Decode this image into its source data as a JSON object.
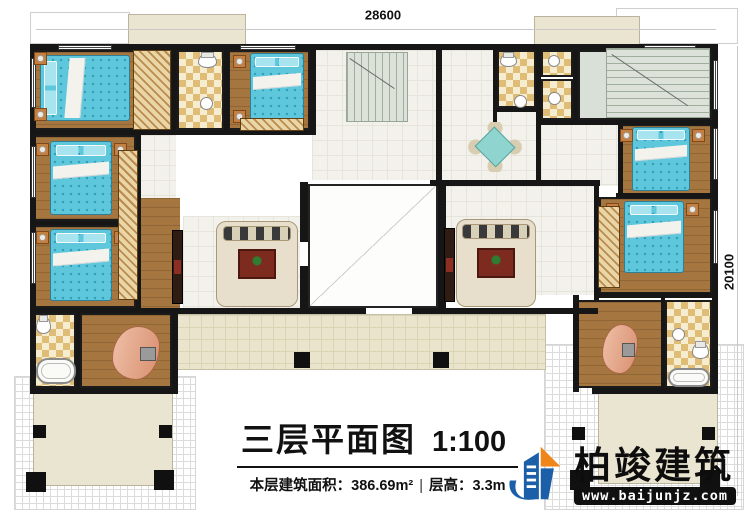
{
  "title_block": {
    "title": "三层平面图",
    "scale": "1:100",
    "area_label": "本层建筑面积：",
    "area_value": "386.69m²",
    "height_label": "层高：",
    "height_value": "3.3m"
  },
  "dimensions": {
    "top": "28600",
    "right": "20100"
  },
  "logo": {
    "name": "柏竣建筑",
    "url": "www.baijunjz.com"
  },
  "watermark": {
    "text": "柏竣建筑",
    "url": "www.baijunjz.com"
  },
  "watermarks": [
    {
      "x": 230,
      "y": 95
    },
    {
      "x": 590,
      "y": 193
    },
    {
      "x": 140,
      "y": 295
    },
    {
      "x": 478,
      "y": 408
    }
  ],
  "plan": {
    "rooms": [
      {
        "id": "lattice-bottom-left",
        "t": "lattice",
        "r": [
          14,
          376,
          182,
          134
        ]
      },
      {
        "id": "lattice-bottom-right",
        "t": "lattice",
        "r": [
          544,
          344,
          200,
          166
        ]
      },
      {
        "id": "roof-top-left",
        "t": "roof",
        "r": [
          30,
          12,
          100,
          32
        ]
      },
      {
        "id": "roof-top-right",
        "t": "roof",
        "r": [
          616,
          8,
          122,
          36
        ]
      },
      {
        "id": "terrace-top-left",
        "t": "terr",
        "r": [
          128,
          14,
          118,
          32
        ]
      },
      {
        "id": "terrace-top-right",
        "t": "terr",
        "r": [
          534,
          16,
          106,
          30
        ]
      },
      {
        "id": "terrace-bottom-left",
        "t": "terr",
        "r": [
          33,
          392,
          140,
          94
        ]
      },
      {
        "id": "terrace-bottom-right",
        "t": "terr",
        "r": [
          598,
          390,
          120,
          94
        ]
      },
      {
        "id": "outer-corridor",
        "t": "corr",
        "r": [
          176,
          314,
          370,
          56
        ]
      },
      {
        "id": "hall-3036",
        "t": "hall",
        "r": [
          312,
          50,
          124,
          130
        ]
      },
      {
        "id": "hall-470",
        "t": "hall",
        "r": [
          139,
          135,
          37,
          63
        ]
      },
      {
        "id": "activity-room",
        "t": "hall",
        "r": [
          436,
          50,
          100,
          130
        ]
      },
      {
        "id": "hall-1018",
        "t": "hall",
        "r": [
          541,
          124,
          77,
          62
        ]
      },
      {
        "id": "home-theater",
        "t": "hall",
        "r": [
          436,
          186,
          158,
          109
        ]
      },
      {
        "id": "multi-function-hall",
        "t": "hall",
        "r": [
          183,
          216,
          117,
          92
        ]
      },
      {
        "id": "closet-strip",
        "t": "woodnb",
        "r": [
          136,
          198,
          44,
          110
        ]
      },
      {
        "id": "bedroom-1935",
        "t": "wood",
        "r": [
          33,
          50,
          139,
          80
        ]
      },
      {
        "id": "bedroom-1028",
        "t": "wood",
        "r": [
          228,
          50,
          82,
          80
        ]
      },
      {
        "id": "bedroom-1364",
        "t": "wood",
        "r": [
          33,
          135,
          103,
          86
        ]
      },
      {
        "id": "bedroom-1931",
        "t": "wood",
        "r": [
          33,
          225,
          103,
          83
        ]
      },
      {
        "id": "study-left",
        "t": "wood",
        "r": [
          80,
          313,
          92,
          75
        ]
      },
      {
        "id": "study-right",
        "t": "wood",
        "r": [
          575,
          300,
          88,
          88
        ]
      },
      {
        "id": "bedroom-1445",
        "t": "wood",
        "r": [
          620,
          124,
          92,
          74
        ]
      },
      {
        "id": "bedroom-1944",
        "t": "wood",
        "r": [
          599,
          197,
          113,
          97
        ]
      },
      {
        "id": "bath-308",
        "t": "bath",
        "r": [
          177,
          50,
          47,
          80
        ]
      },
      {
        "id": "bath-337",
        "t": "bath",
        "r": [
          497,
          50,
          39,
          58
        ]
      },
      {
        "id": "bath-177",
        "t": "bath",
        "r": [
          541,
          50,
          32,
          27
        ]
      },
      {
        "id": "bath-232",
        "t": "bath",
        "r": [
          541,
          79,
          32,
          41
        ]
      },
      {
        "id": "bath-551",
        "t": "bath",
        "r": [
          33,
          313,
          43,
          75
        ]
      },
      {
        "id": "bath-618",
        "t": "bath",
        "r": [
          665,
          300,
          47,
          88
        ]
      },
      {
        "id": "stair-room",
        "t": "stairroom",
        "r": [
          578,
          50,
          134,
          70
        ]
      },
      {
        "id": "living-void",
        "t": "void",
        "r": [
          308,
          184,
          130,
          124
        ]
      }
    ],
    "walls": [
      [
        30,
        44,
        688,
        6
      ],
      [
        30,
        44,
        6,
        350
      ],
      [
        712,
        44,
        6,
        350
      ],
      [
        30,
        388,
        148,
        6
      ],
      [
        592,
        388,
        126,
        6
      ],
      [
        176,
        308,
        190,
        6
      ],
      [
        412,
        308,
        186,
        6
      ],
      [
        30,
        130,
        286,
        5
      ],
      [
        172,
        46,
        5,
        88
      ],
      [
        224,
        46,
        5,
        88
      ],
      [
        310,
        46,
        6,
        88
      ],
      [
        136,
        133,
        5,
        178
      ],
      [
        30,
        221,
        108,
        4
      ],
      [
        30,
        308,
        148,
        5
      ],
      [
        76,
        311,
        4,
        80
      ],
      [
        172,
        308,
        6,
        86
      ],
      [
        436,
        44,
        6,
        140
      ],
      [
        536,
        44,
        5,
        140
      ],
      [
        300,
        182,
        8,
        60
      ],
      [
        300,
        266,
        8,
        46
      ],
      [
        438,
        182,
        8,
        128
      ],
      [
        430,
        180,
        170,
        6
      ],
      [
        493,
        46,
        4,
        76
      ],
      [
        573,
        44,
        5,
        80
      ],
      [
        495,
        108,
        45,
        4
      ],
      [
        536,
        120,
        180,
        5
      ],
      [
        618,
        124,
        5,
        74
      ],
      [
        594,
        186,
        5,
        114
      ],
      [
        573,
        295,
        6,
        97
      ],
      [
        594,
        293,
        122,
        5
      ],
      [
        661,
        298,
        4,
        92
      ],
      [
        616,
        193,
        100,
        5
      ]
    ],
    "windows": [
      {
        "o": "h",
        "r": [
          58,
          45,
          54,
          5
        ]
      },
      {
        "o": "h",
        "r": [
          240,
          45,
          56,
          5
        ]
      },
      {
        "o": "h",
        "r": [
          644,
          45,
          52,
          5
        ]
      },
      {
        "o": "v",
        "r": [
          31,
          58,
          5,
          50
        ]
      },
      {
        "o": "v",
        "r": [
          31,
          146,
          5,
          52
        ]
      },
      {
        "o": "v",
        "r": [
          31,
          232,
          5,
          52
        ]
      },
      {
        "o": "v",
        "r": [
          713,
          60,
          5,
          50
        ]
      },
      {
        "o": "v",
        "r": [
          713,
          128,
          5,
          52
        ]
      },
      {
        "o": "v",
        "r": [
          713,
          210,
          5,
          54
        ]
      }
    ],
    "columns": [
      [
        294,
        352,
        16
      ],
      [
        433,
        352,
        16
      ],
      [
        33,
        425,
        13
      ],
      [
        159,
        425,
        13
      ],
      [
        26,
        472,
        20
      ],
      [
        154,
        470,
        20
      ],
      [
        572,
        427,
        13
      ],
      [
        702,
        427,
        13
      ],
      [
        570,
        470,
        20
      ],
      [
        700,
        470,
        20
      ]
    ],
    "furniture": [
      {
        "t": "bed",
        "v": "h",
        "r": [
          40,
          55,
          90,
          66
        ]
      },
      {
        "t": "bed",
        "v": "v",
        "r": [
          50,
          141,
          62,
          74
        ]
      },
      {
        "t": "bed",
        "v": "v",
        "r": [
          50,
          229,
          62,
          72
        ]
      },
      {
        "t": "bed",
        "v": "v",
        "r": [
          250,
          53,
          54,
          72
        ]
      },
      {
        "t": "bed",
        "v": "v",
        "r": [
          632,
          127,
          58,
          64
        ]
      },
      {
        "t": "bed",
        "v": "v",
        "r": [
          624,
          201,
          60,
          72
        ]
      },
      {
        "t": "night",
        "r": [
          34,
          52,
          13,
          13
        ]
      },
      {
        "t": "night",
        "r": [
          34,
          108,
          13,
          13
        ]
      },
      {
        "t": "night",
        "r": [
          36,
          143,
          13,
          13
        ]
      },
      {
        "t": "night",
        "r": [
          114,
          143,
          13,
          13
        ]
      },
      {
        "t": "night",
        "r": [
          36,
          231,
          13,
          13
        ]
      },
      {
        "t": "night",
        "r": [
          114,
          231,
          13,
          13
        ]
      },
      {
        "t": "night",
        "r": [
          233,
          55,
          13,
          13
        ]
      },
      {
        "t": "night",
        "r": [
          233,
          110,
          13,
          13
        ]
      },
      {
        "t": "night",
        "r": [
          620,
          129,
          13,
          13
        ]
      },
      {
        "t": "night",
        "r": [
          692,
          129,
          13,
          13
        ]
      },
      {
        "t": "night",
        "r": [
          606,
          203,
          13,
          13
        ]
      },
      {
        "t": "night",
        "r": [
          686,
          203,
          13,
          13
        ]
      },
      {
        "t": "wardrobe",
        "r": [
          133,
          50,
          38,
          80
        ]
      },
      {
        "t": "wardrobe",
        "r": [
          118,
          150,
          20,
          150
        ]
      },
      {
        "t": "wardrobe",
        "r": [
          598,
          206,
          22,
          82
        ]
      },
      {
        "t": "wardrobe",
        "r": [
          240,
          118,
          64,
          13
        ]
      },
      {
        "t": "cabinet",
        "r": [
          172,
          230,
          11,
          74
        ]
      },
      {
        "t": "cabinet",
        "r": [
          444,
          228,
          11,
          74
        ]
      },
      {
        "t": "sofa",
        "r": [
          216,
          221,
          82,
          86
        ]
      },
      {
        "t": "sofa",
        "r": [
          456,
          219,
          80,
          88
        ]
      },
      {
        "t": "dining",
        "r": [
          468,
          122,
          54,
          50
        ]
      },
      {
        "t": "desk",
        "r": [
          112,
          326,
          48,
          54
        ]
      },
      {
        "t": "desk",
        "r": [
          602,
          324,
          36,
          50
        ]
      },
      {
        "t": "tub",
        "r": [
          36,
          358,
          40,
          26
        ]
      },
      {
        "t": "tub",
        "r": [
          668,
          368,
          42,
          19
        ]
      },
      {
        "t": "toilet",
        "r": [
          198,
          53,
          19,
          15
        ]
      },
      {
        "t": "toilet",
        "r": [
          500,
          53,
          17,
          14
        ]
      },
      {
        "t": "toilet",
        "r": [
          692,
          342,
          17,
          17
        ]
      },
      {
        "t": "toilet",
        "r": [
          36,
          316,
          15,
          18
        ]
      },
      {
        "t": "basin",
        "r": [
          200,
          97,
          13,
          13
        ]
      },
      {
        "t": "basin",
        "r": [
          514,
          95,
          13,
          13
        ]
      },
      {
        "t": "basin",
        "r": [
          548,
          55,
          12,
          12
        ]
      },
      {
        "t": "basin",
        "r": [
          548,
          92,
          13,
          13
        ]
      },
      {
        "t": "basin",
        "r": [
          672,
          328,
          13,
          13
        ]
      },
      {
        "t": "stairs",
        "v": "h",
        "r": [
          346,
          52,
          62,
          70
        ]
      },
      {
        "t": "stairs",
        "v": "v",
        "r": [
          606,
          48,
          104,
          70
        ]
      }
    ],
    "labels": [
      {
        "id": "terrace-top-left",
        "lines": [
          "露台"
        ],
        "x": 170,
        "y": 31
      },
      {
        "id": "terrace-top-right",
        "lines": [
          "露台"
        ],
        "x": 584,
        "y": 31
      },
      {
        "id": "bedroom-1935",
        "lines": [
          "卧室",
          "19.35m²"
        ],
        "x": 112,
        "y": 101
      },
      {
        "id": "bath-308",
        "lines": [
          "公卫",
          "3.08m²"
        ],
        "x": 196,
        "y": 77
      },
      {
        "id": "area-302",
        "cls": "small",
        "lines": [
          "3.02m²"
        ],
        "x": 191,
        "y": 114
      },
      {
        "id": "bedroom-1028",
        "lines": [
          "卧室",
          "10.28m²"
        ],
        "x": 264,
        "y": 103
      },
      {
        "id": "bedroom-1364",
        "lines": [
          "卧室",
          "13.64m²"
        ],
        "x": 88,
        "y": 203
      },
      {
        "id": "area-470",
        "cls": "small",
        "lines": [
          "4.70m²"
        ],
        "x": 160,
        "y": 172
      },
      {
        "id": "area-3036",
        "cls": "small",
        "lines": [
          "30.36m²"
        ],
        "x": 391,
        "y": 147
      },
      {
        "id": "down-left",
        "cls": "dir",
        "lines": [
          "下"
        ],
        "x": 414,
        "y": 68
      },
      {
        "id": "activity-room",
        "lines": [
          "活动室",
          "16.69m²"
        ],
        "x": 470,
        "y": 99
      },
      {
        "id": "bath-337",
        "lines": [
          "公卫",
          "3.37m²"
        ],
        "x": 513,
        "y": 84
      },
      {
        "id": "area-177",
        "cls": "small",
        "lines": [
          "1.77m²"
        ],
        "x": 554,
        "y": 61
      },
      {
        "id": "bath-232",
        "lines": [
          "公卫",
          "2.32m²"
        ],
        "x": 558,
        "y": 103
      },
      {
        "id": "up-right",
        "cls": "dir",
        "lines": [
          "上"
        ],
        "x": 598,
        "y": 60
      },
      {
        "id": "stair-room",
        "lines": [
          "楼梯间",
          "15.68m²"
        ],
        "x": 601,
        "y": 81
      },
      {
        "id": "down-right",
        "cls": "dir",
        "lines": [
          "下"
        ],
        "x": 598,
        "y": 108
      },
      {
        "id": "area-1018",
        "cls": "small",
        "lines": [
          "10.18m²"
        ],
        "x": 580,
        "y": 154
      },
      {
        "id": "bedroom-1445",
        "lines": [
          "卧室",
          "14.45m²"
        ],
        "x": 674,
        "y": 192
      },
      {
        "id": "multi-function-hall",
        "lines": [
          "多功能厅",
          "41.78m²"
        ],
        "x": 204,
        "y": 272
      },
      {
        "id": "living-void",
        "lines": [
          "客厅上空",
          "31.69m²"
        ],
        "x": 376,
        "y": 249
      },
      {
        "id": "home-theater",
        "lines": [
          "家庭影院",
          "28.56m²"
        ],
        "x": 502,
        "y": 252
      },
      {
        "id": "bedroom-1944",
        "lines": [
          "卧室",
          "19.44m²"
        ],
        "x": 668,
        "y": 284
      },
      {
        "id": "bedroom-1931",
        "lines": [
          "卧室",
          "19.31m²"
        ],
        "x": 74,
        "y": 291
      },
      {
        "id": "bath-551",
        "lines": [
          "内卫",
          "5.51m²"
        ],
        "x": 57,
        "y": 354
      },
      {
        "id": "study-left",
        "lines": [
          "书房",
          "12.53m²"
        ],
        "x": 107,
        "y": 356
      },
      {
        "id": "bath-618",
        "lines": [
          "内卫",
          "6.18m²"
        ],
        "x": 686,
        "y": 337
      },
      {
        "id": "study-right",
        "lines": [
          "书房",
          "13.91m²"
        ],
        "x": 645,
        "y": 362
      },
      {
        "id": "outer-corridor",
        "lines": [
          "外走廊",
          "16.79m²"
        ],
        "x": 368,
        "y": 346
      },
      {
        "id": "pavilion-left",
        "lines": [
          "凉亭",
          "5.13m²"
        ],
        "x": 103,
        "y": 410
      },
      {
        "id": "terrace-bottom-left",
        "lines": [
          "露台"
        ],
        "x": 121,
        "y": 452
      },
      {
        "id": "pavilion-right",
        "lines": [
          "凉亭",
          "5.13m²"
        ],
        "x": 645,
        "y": 414
      },
      {
        "id": "terrace-bottom-right",
        "lines": [
          "露台"
        ],
        "x": 628,
        "y": 452
      }
    ]
  }
}
